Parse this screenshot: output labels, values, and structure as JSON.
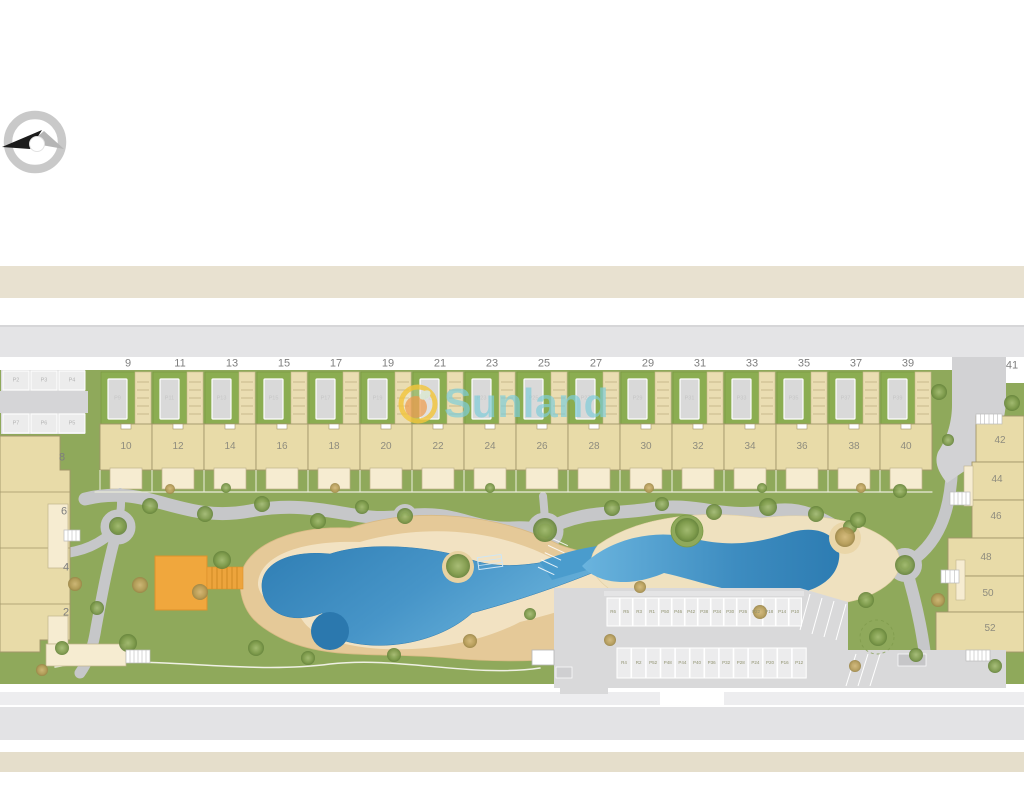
{
  "watermark": {
    "brand": "Sunland"
  },
  "top_row": {
    "plot_numbers": [
      "9",
      "11",
      "13",
      "15",
      "17",
      "19",
      "21",
      "23",
      "25",
      "27",
      "29",
      "31",
      "33",
      "35",
      "37",
      "39"
    ],
    "parking_labels": [
      "P9",
      "P11",
      "P13",
      "P15",
      "P17",
      "P19",
      "P21",
      "P23",
      "P25",
      "P27",
      "P29",
      "P31",
      "P33",
      "P35",
      "P37",
      "P39"
    ],
    "unit_numbers": [
      "10",
      "12",
      "14",
      "16",
      "18",
      "20",
      "22",
      "24",
      "26",
      "28",
      "30",
      "32",
      "34",
      "36",
      "38",
      "40"
    ]
  },
  "left_block": {
    "parking_top": [
      "P2",
      "P3",
      "P4"
    ],
    "parking_bottom": [
      "P7",
      "P6",
      "P5"
    ],
    "unit_numbers": [
      "8",
      "6",
      "4",
      "2"
    ]
  },
  "right_block": {
    "corner_number": "41",
    "unit_numbers": [
      "42",
      "44",
      "46",
      "48",
      "50",
      "52"
    ]
  },
  "parking_lot": {
    "row_top": [
      "R6",
      "R5",
      "R3",
      "R1",
      "P50",
      "P46",
      "P42",
      "P38",
      "P34",
      "P30",
      "P26",
      "P22",
      "P18",
      "P14",
      "P10"
    ],
    "row_bottom": [
      "R4",
      "R2",
      "P52",
      "P48",
      "P44",
      "P40",
      "P36",
      "P32",
      "P28",
      "P24",
      "P20",
      "P16",
      "P12"
    ]
  },
  "icons": {
    "compass": "north-arrow-icon",
    "logo": "sunland-sun-icon"
  },
  "colors": {
    "lawn": "#8fa95b",
    "garden": "#8bad51",
    "sand": "#e5c998",
    "sand_light": "#f2e4c4",
    "pool_deep": "#2e7cb2",
    "pool_light": "#68b1da",
    "unit": "#e8dba8",
    "terrace": "#f6ecd1",
    "path": "#c6c7c9",
    "road_beige": "#e8e1d0",
    "road_gray": "#e4e4e6",
    "playground": "#f0a73d",
    "brand_teal": "#7fcdd8",
    "brand_yellow": "#f3c63e"
  }
}
